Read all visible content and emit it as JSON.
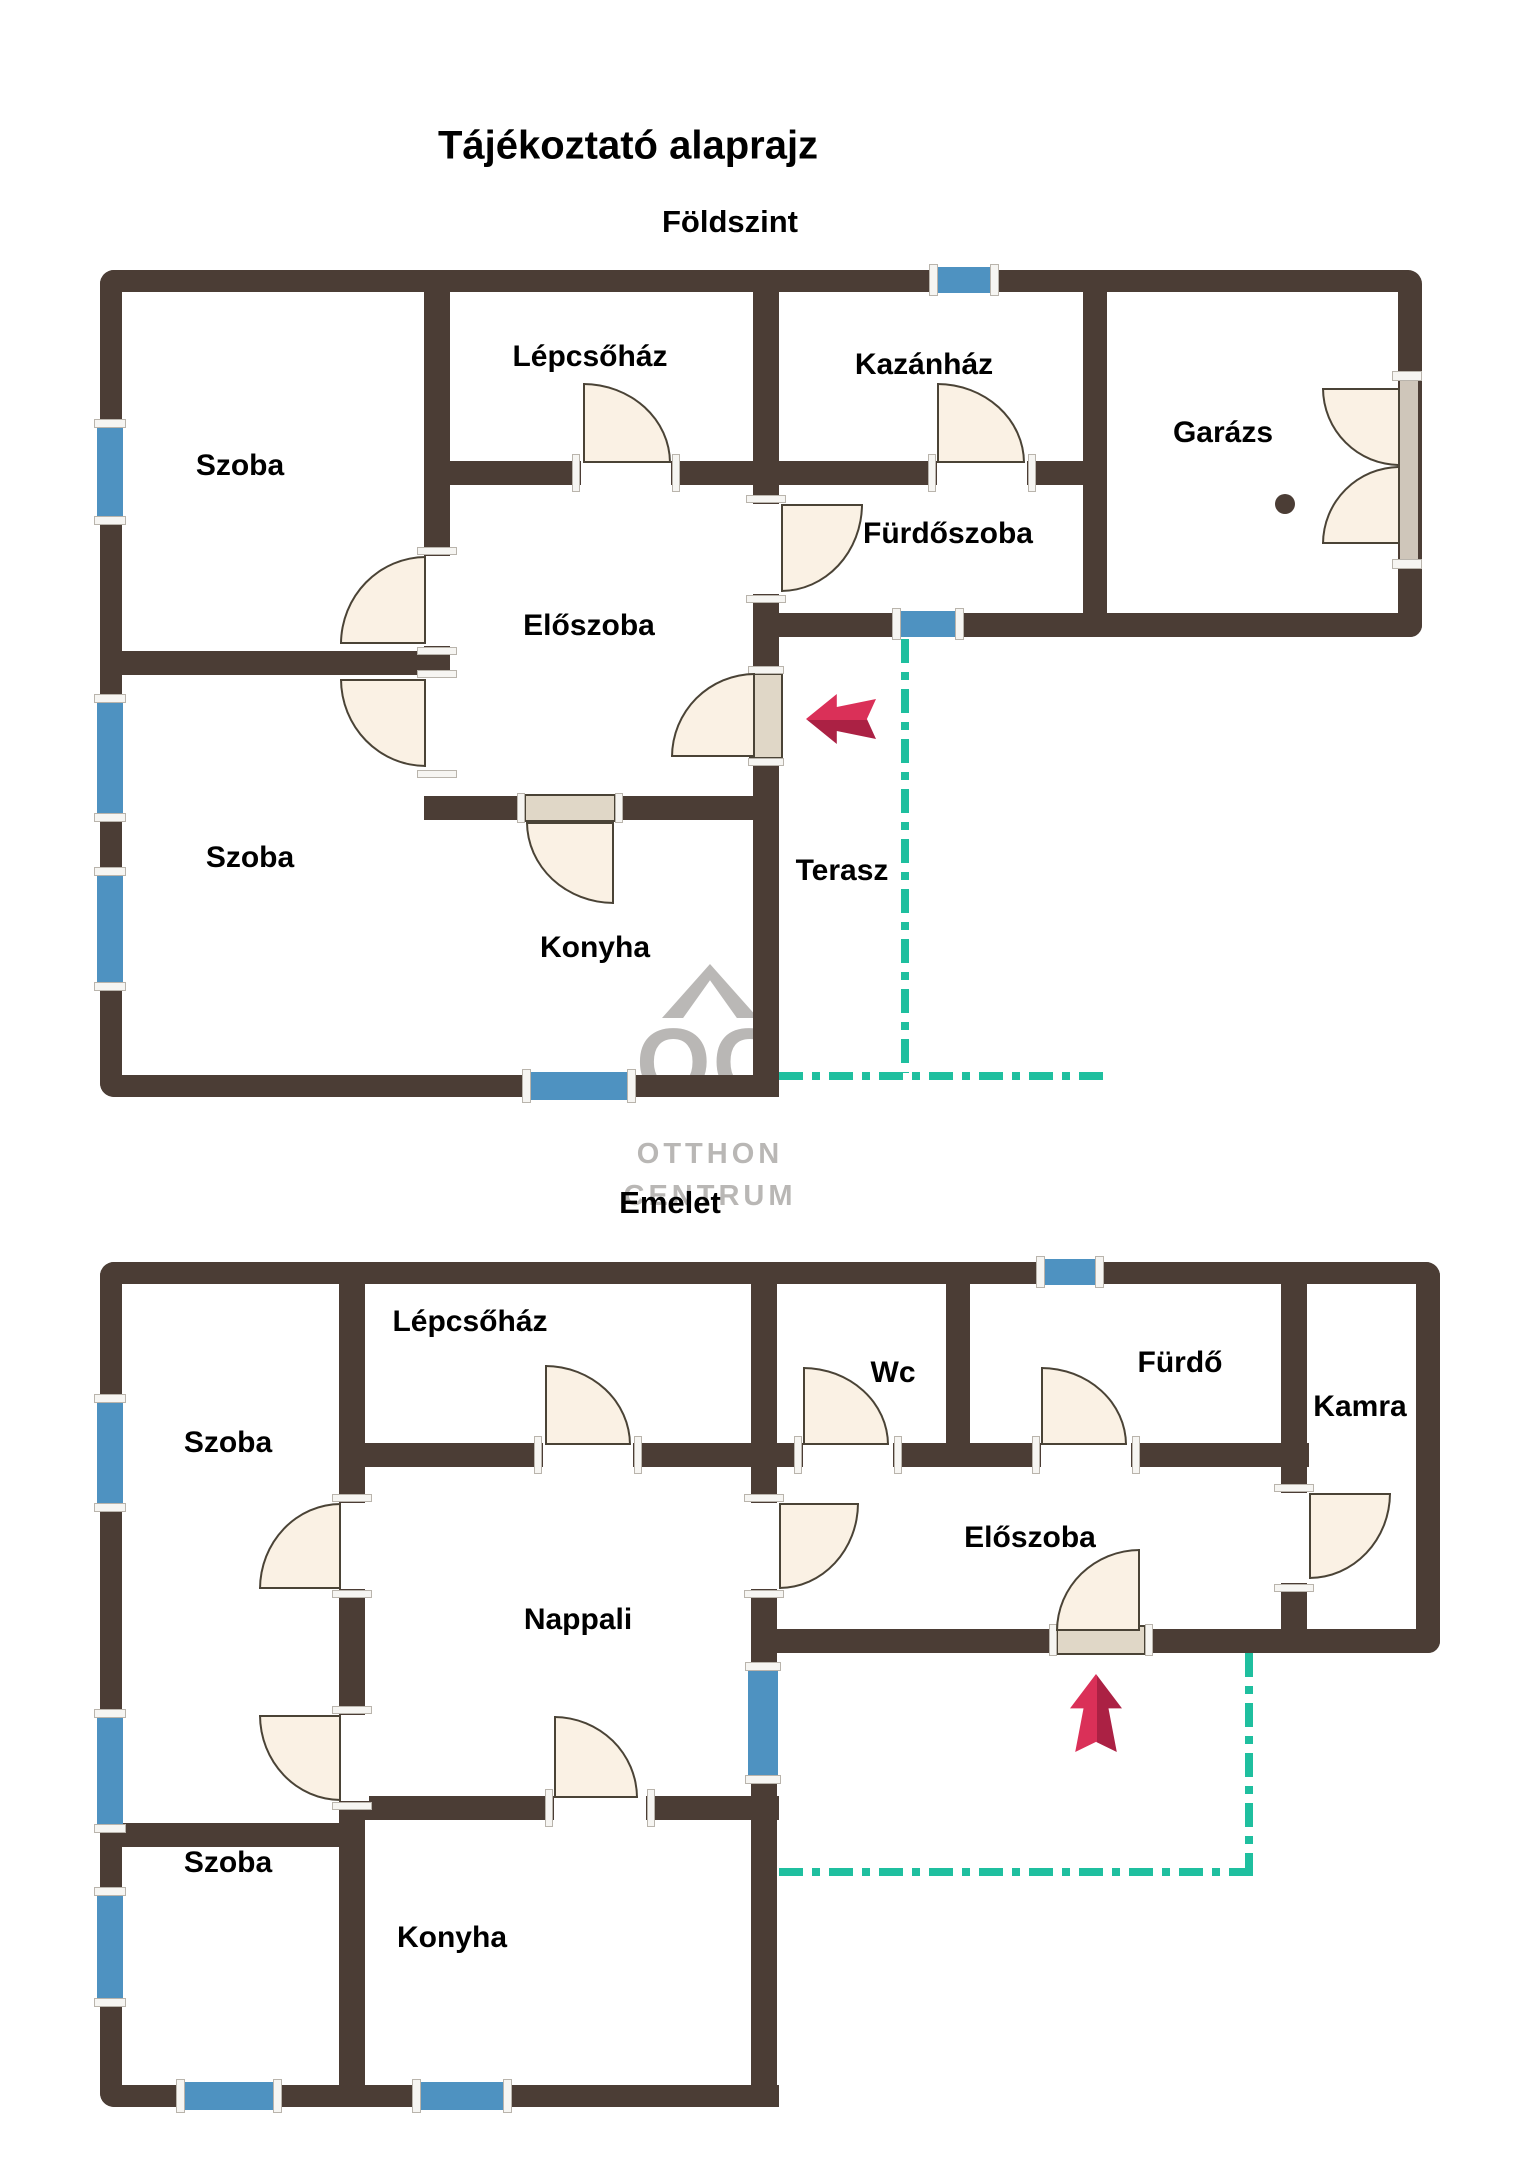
{
  "title": "Tájékoztató alaprajz",
  "logo": {
    "monogram": "OC",
    "line1": "OTTHON",
    "line2": "CENTRUM"
  },
  "colors": {
    "wall": "#4b3d35",
    "door_fill": "#faf1e4",
    "window_blue": "#4e92c1",
    "terrace_line_teal": "#1fbf9f",
    "arrow_red": "#d22b52",
    "logo_gray": "#b9b7b5"
  },
  "ground_floor": {
    "name": "Földszint",
    "rooms": [
      {
        "label": "Szoba"
      },
      {
        "label": "Lépcsőház"
      },
      {
        "label": "Kazánház"
      },
      {
        "label": "Garázs"
      },
      {
        "label": "Fürdőszoba"
      },
      {
        "label": "Előszoba"
      },
      {
        "label": "Szoba"
      },
      {
        "label": "Konyha"
      },
      {
        "label": "Terasz"
      }
    ]
  },
  "upper_floor": {
    "name": "Emelet",
    "rooms": [
      {
        "label": "Szoba"
      },
      {
        "label": "Lépcsőház"
      },
      {
        "label": "Wc"
      },
      {
        "label": "Fürdő"
      },
      {
        "label": "Kamra"
      },
      {
        "label": "Előszoba"
      },
      {
        "label": "Nappali"
      },
      {
        "label": "Szoba"
      },
      {
        "label": "Konyha"
      }
    ]
  }
}
